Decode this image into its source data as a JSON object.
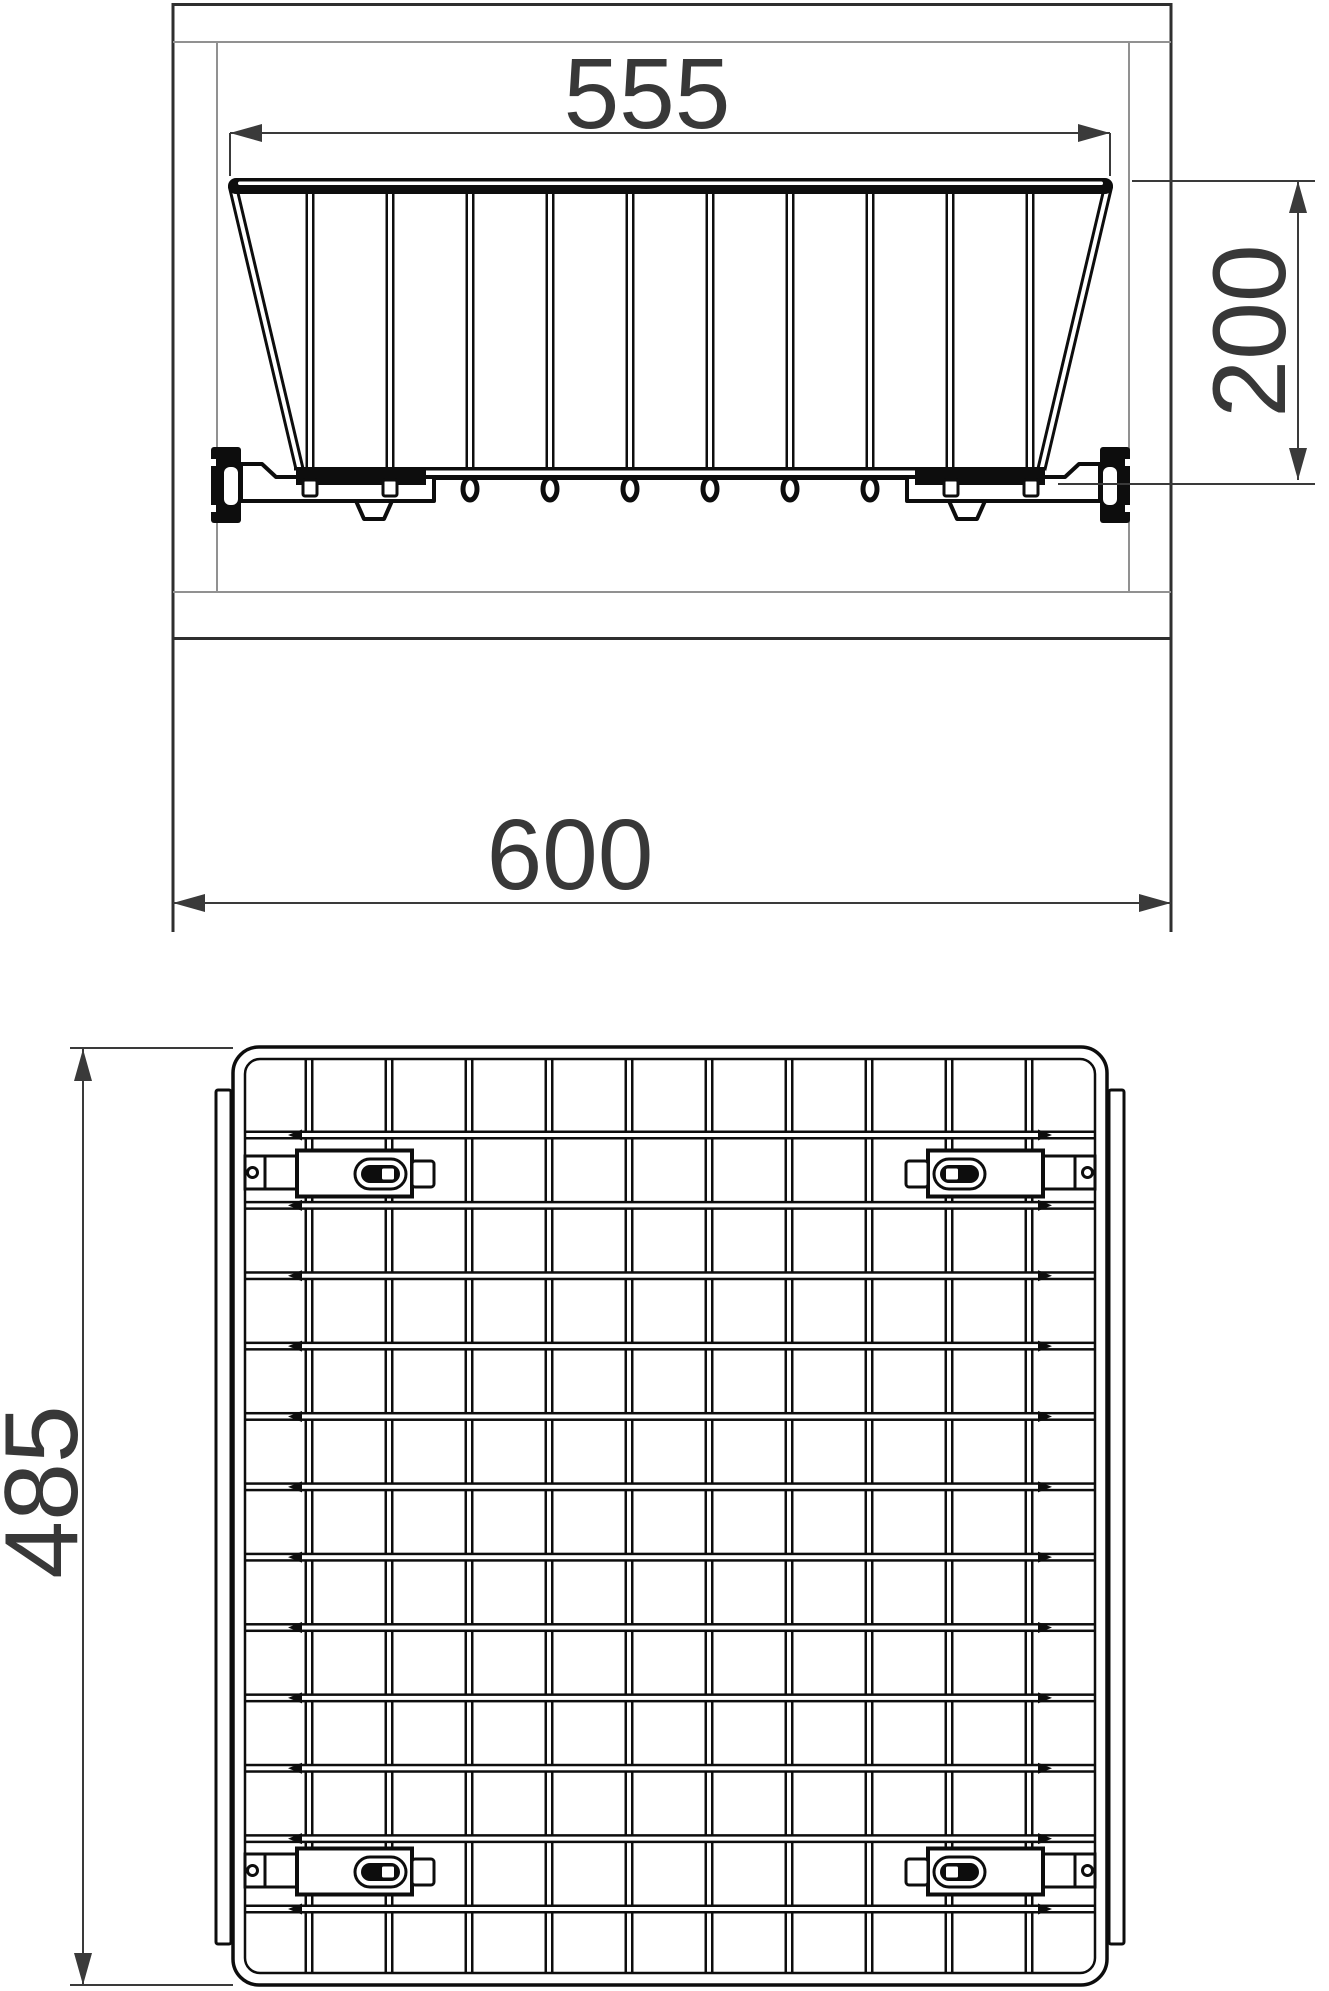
{
  "dimensions": {
    "basket_top_width": "555",
    "basket_height": "200",
    "cabinet_width": "600",
    "basket_depth": "485"
  },
  "colors": {
    "background": "#ffffff",
    "line_dark": "#2f2f2f",
    "line_light": "#919191",
    "wire": "#0d0d0d",
    "dimension": "#3a3a3a",
    "text": "#383838"
  }
}
